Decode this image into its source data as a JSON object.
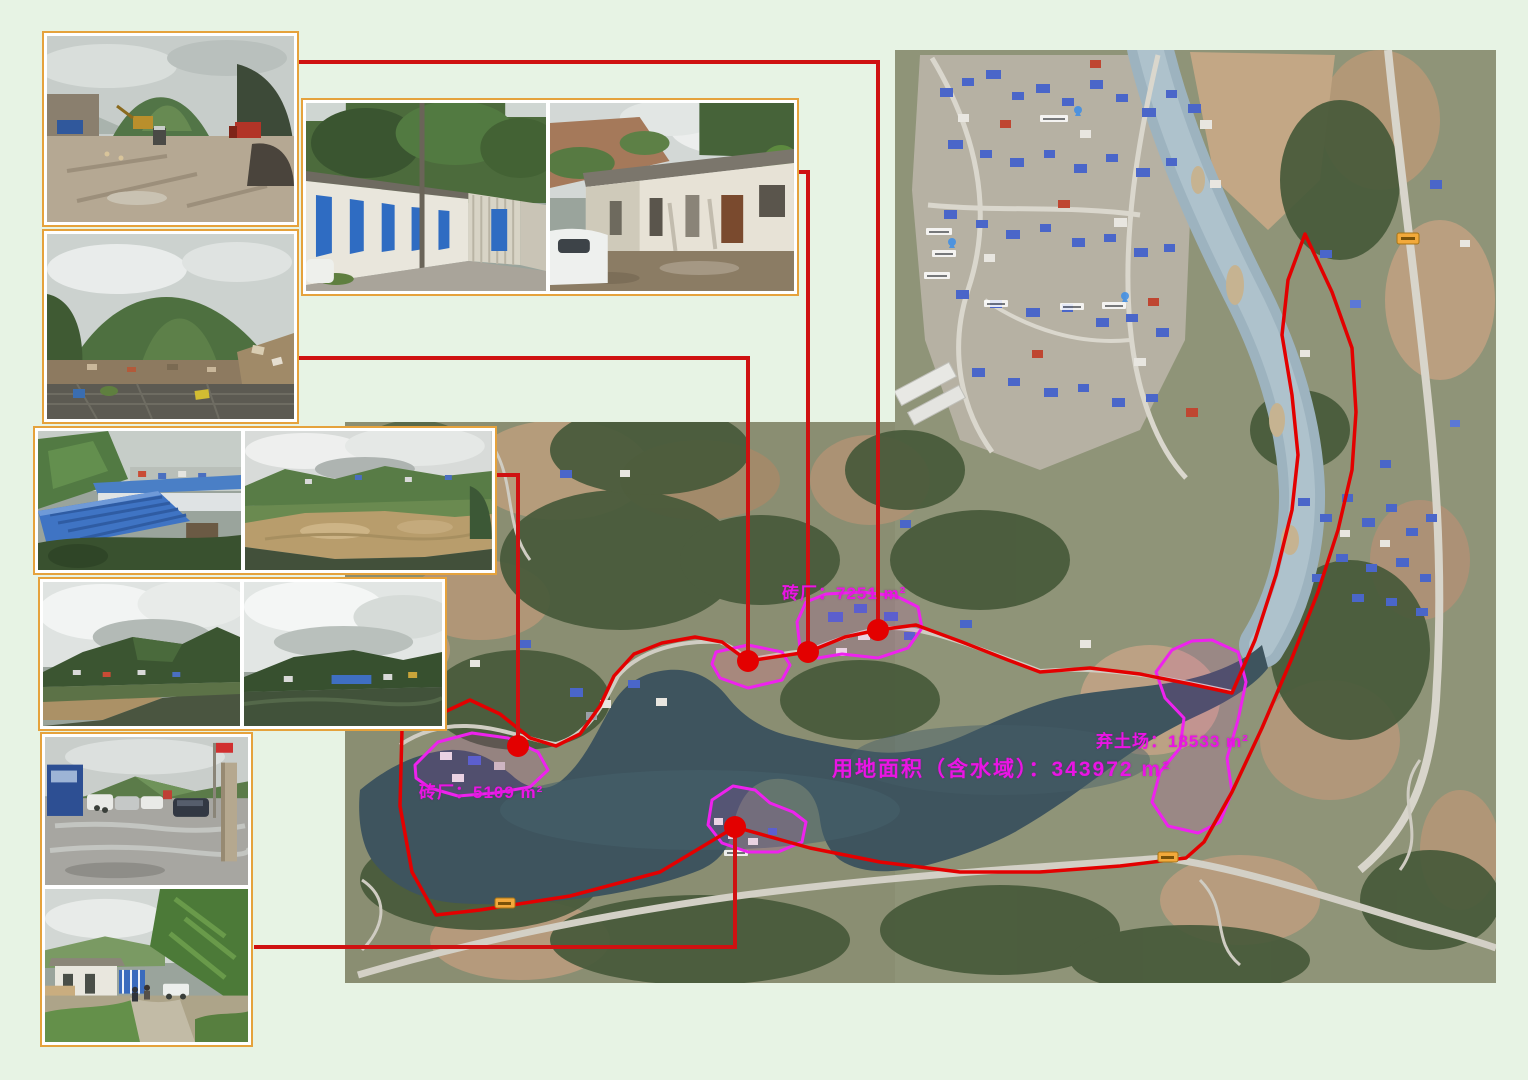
{
  "page": {
    "background_color": "#e7f3e4",
    "kind": "land-acquisition survey sheet: satellite map with project boundary, site outlines and field photos"
  },
  "map": {
    "boundary_color": "#e30000",
    "site_outline_color": "#ee22ee",
    "leader_line_color": "#cf1111",
    "labels": [
      {
        "id": "brick-plant-7251",
        "text": "砖厂：7251 m²"
      },
      {
        "id": "total-land-area",
        "text": "用地面积（含水域）：343972 m²"
      },
      {
        "id": "spoil-ground-18533",
        "text": "弃土场：18533 m²"
      },
      {
        "id": "brick-plant-5109",
        "text": "砖厂：5109 m²"
      }
    ],
    "markers": [
      {
        "id": "marker-brick-7251"
      },
      {
        "id": "marker-houses-site"
      },
      {
        "id": "marker-yard-site"
      },
      {
        "id": "marker-brick-5109"
      },
      {
        "id": "marker-peninsula-site"
      }
    ],
    "icons": {
      "site_marker": "red-dot-icon",
      "route_badge": "orange-road-number-badge-icon",
      "poi_pin": "blue-map-pin-icon"
    }
  },
  "photo_panels": [
    {
      "id": "construction-yard",
      "subject": "construction yard with excavator and trucks"
    },
    {
      "id": "debris-hill",
      "subject": "demolition debris below green hill"
    },
    {
      "id": "old-houses",
      "subject": "two photos of single-storey houses with blue and brown doors"
    },
    {
      "id": "riverside-panorama",
      "subject": "blue-roofed sheds and muddy river panorama"
    },
    {
      "id": "dark-hillside-panorama",
      "subject": "two overcast hillside village views"
    },
    {
      "id": "parking-and-hillside",
      "subject": "wet parking lot with vehicles and green hillside camp"
    }
  ]
}
